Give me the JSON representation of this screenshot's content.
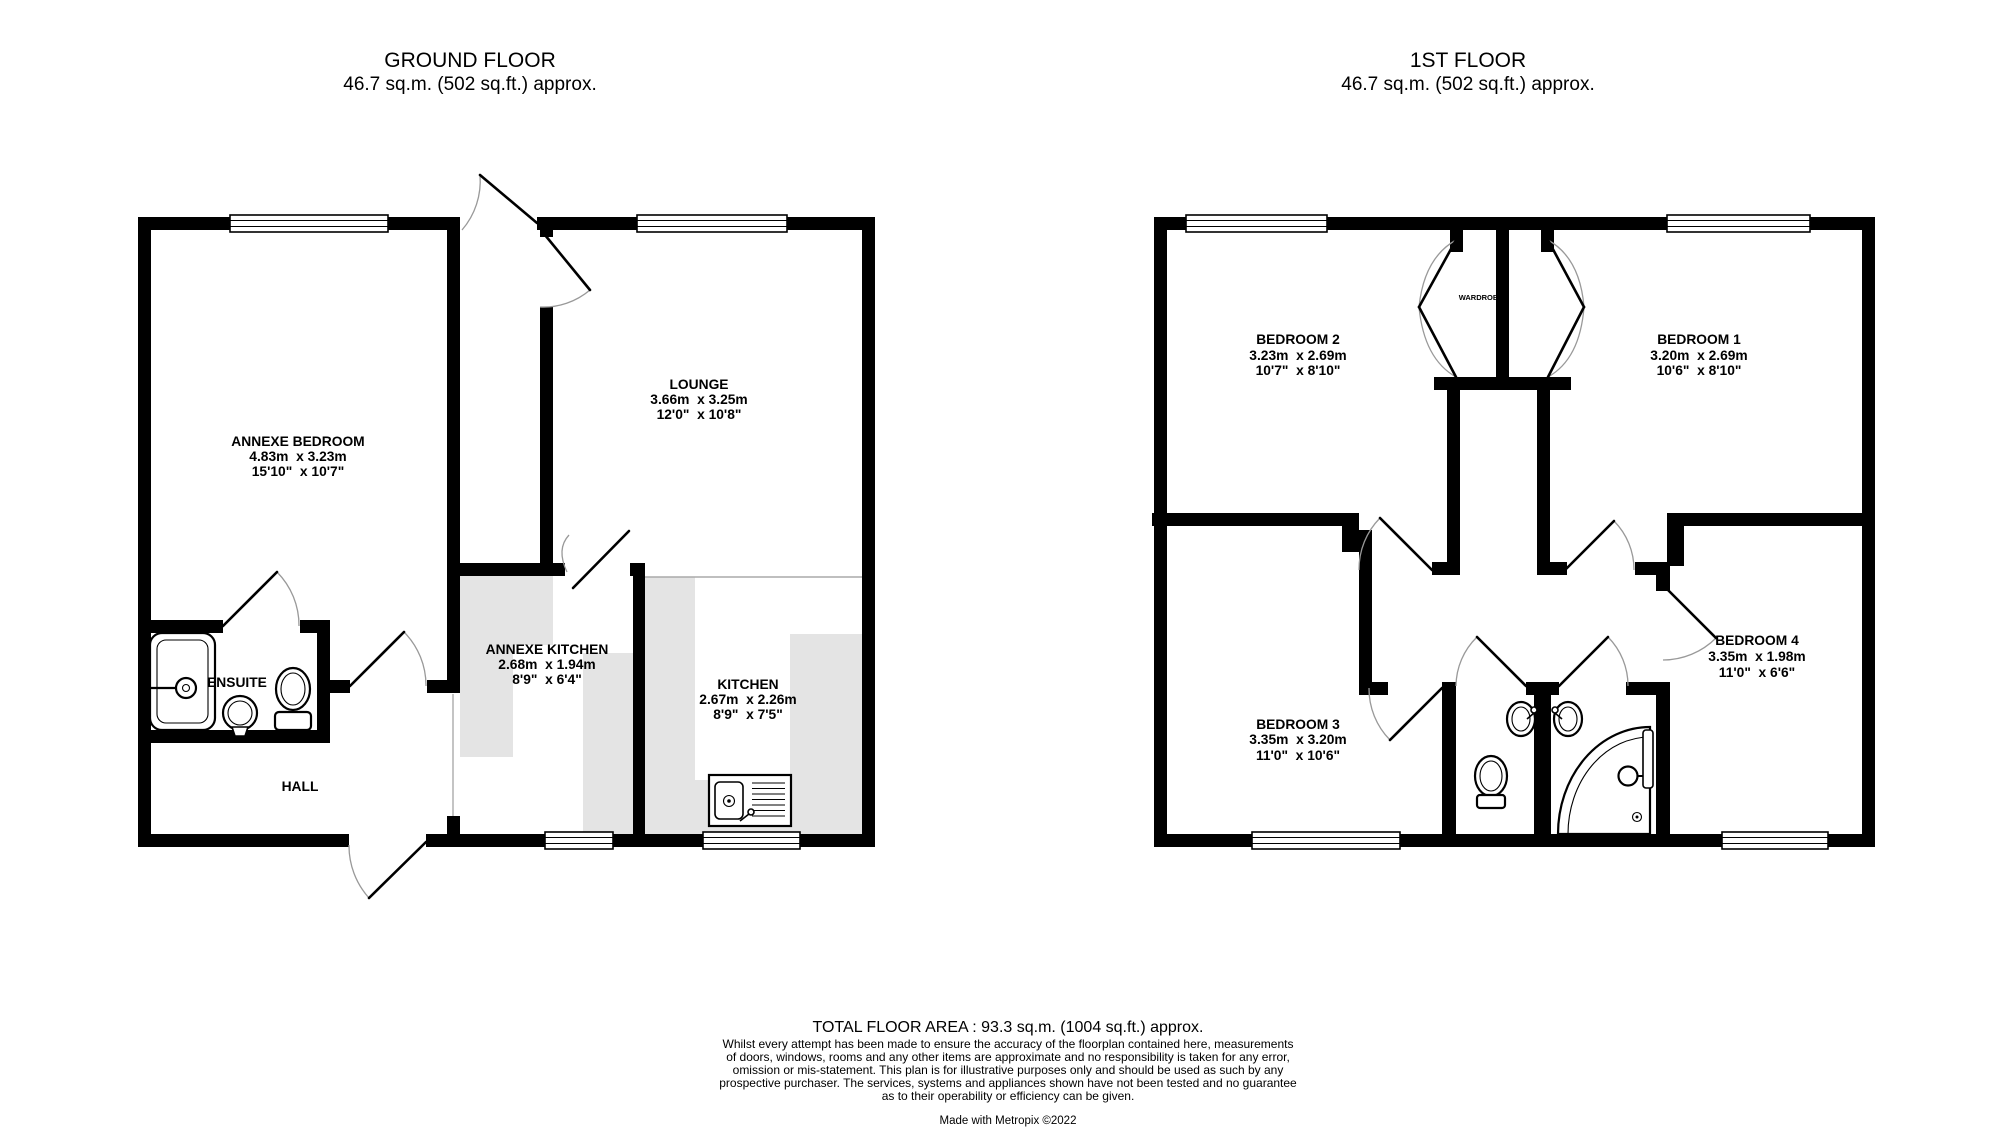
{
  "colors": {
    "wall": "#000000",
    "counter": "#e4e4e4",
    "door_arc": "#999999",
    "background": "#ffffff",
    "text": "#000000"
  },
  "ground_floor": {
    "title": "GROUND FLOOR",
    "area": "46.7 sq.m. (502 sq.ft.) approx.",
    "rooms": {
      "annexe_bedroom": {
        "name": "ANNEXE BEDROOM",
        "metric": "4.83m  x 3.23m",
        "imperial": "15'10\"  x 10'7\""
      },
      "lounge": {
        "name": "LOUNGE",
        "metric": "3.66m  x 3.25m",
        "imperial": "12'0\"  x 10'8\""
      },
      "annexe_kitchen": {
        "name": "ANNEXE KITCHEN",
        "metric": "2.68m  x 1.94m",
        "imperial": "8'9\"  x 6'4\""
      },
      "kitchen": {
        "name": "KITCHEN",
        "metric": "2.67m  x 2.26m",
        "imperial": "8'9\"  x 7'5\""
      },
      "ensuite": {
        "name": "ENSUITE"
      },
      "hall": {
        "name": "HALL"
      }
    }
  },
  "first_floor": {
    "title": "1ST FLOOR",
    "area": "46.7 sq.m. (502 sq.ft.) approx.",
    "rooms": {
      "bedroom1": {
        "name": "BEDROOM 1",
        "metric": "3.20m  x 2.69m",
        "imperial": "10'6\"  x 8'10\""
      },
      "bedroom2": {
        "name": "BEDROOM 2",
        "metric": "3.23m  x 2.69m",
        "imperial": "10'7\"  x 8'10\""
      },
      "bedroom3": {
        "name": "BEDROOM 3",
        "metric": "3.35m  x 3.20m",
        "imperial": "11'0\"  x 10'6\""
      },
      "bedroom4": {
        "name": "BEDROOM 4",
        "metric": "3.35m  x 1.98m",
        "imperial": "11'0\"  x 6'6\""
      },
      "wardrobe": {
        "name": "WARDROBE"
      }
    }
  },
  "footer": {
    "total_area": "TOTAL FLOOR AREA : 93.3 sq.m. (1004 sq.ft.) approx.",
    "disclaimer": [
      "Whilst every attempt has been made to ensure the accuracy of the floorplan contained here, measurements",
      "of doors, windows, rooms and any other items are approximate and no responsibility is taken for any error,",
      "omission or mis-statement. This plan is for illustrative purposes only and should be used as such by any",
      "prospective purchaser. The services, systems and appliances shown have not been tested and no guarantee",
      "as to their operability or efficiency can be given.",
      "Made with Metropix ©2022"
    ],
    "credit": "Made with Metropix ©2022"
  }
}
